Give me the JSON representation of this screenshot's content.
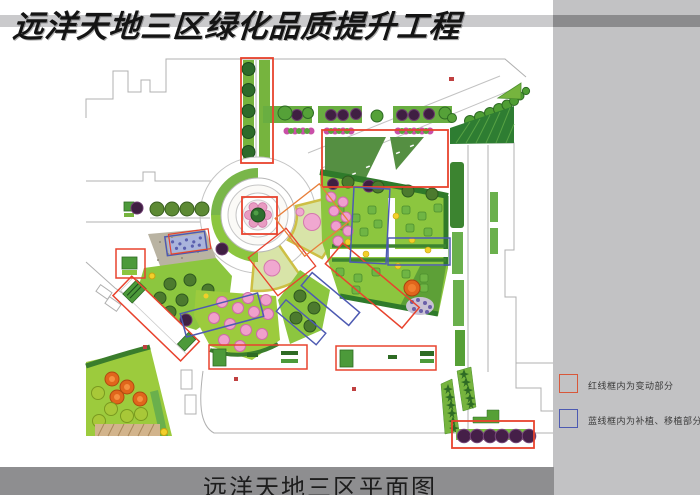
{
  "header": {
    "title": "远洋天地三区绿化品质提升工程"
  },
  "footer": {
    "title": "远洋天地三区平面图"
  },
  "legend": {
    "items": [
      {
        "label": "红线框内为变动部分",
        "color": "#d8573a",
        "meaning": "changed-area"
      },
      {
        "label": "蓝线框内为补植、移植部分",
        "color": "#4d5ab2",
        "meaning": "replant-transplant-area"
      }
    ]
  },
  "plan": {
    "annotation_colors": {
      "changed": "#e8432e",
      "replant": "#4d5ab2"
    },
    "palette": {
      "lawn_light": "#9ccb3d",
      "lawn": "#8cc63f",
      "lawn_dark": "#558f42",
      "hedge_dark": "#2f7a2a",
      "tree_green": "#4f9e34",
      "tree_olive": "#4c7a2e",
      "tree_purple": "#451f48",
      "tree_pink": "#f0a0cc",
      "tree_orange": "#e0661c",
      "shrub_magenta": "#c94fa8",
      "paving_tan": "#d2b48c",
      "side_bar_gray": "#c2c2c4",
      "band_gray": "#8e8e90",
      "outline_gray": "#b0b0b0"
    }
  }
}
